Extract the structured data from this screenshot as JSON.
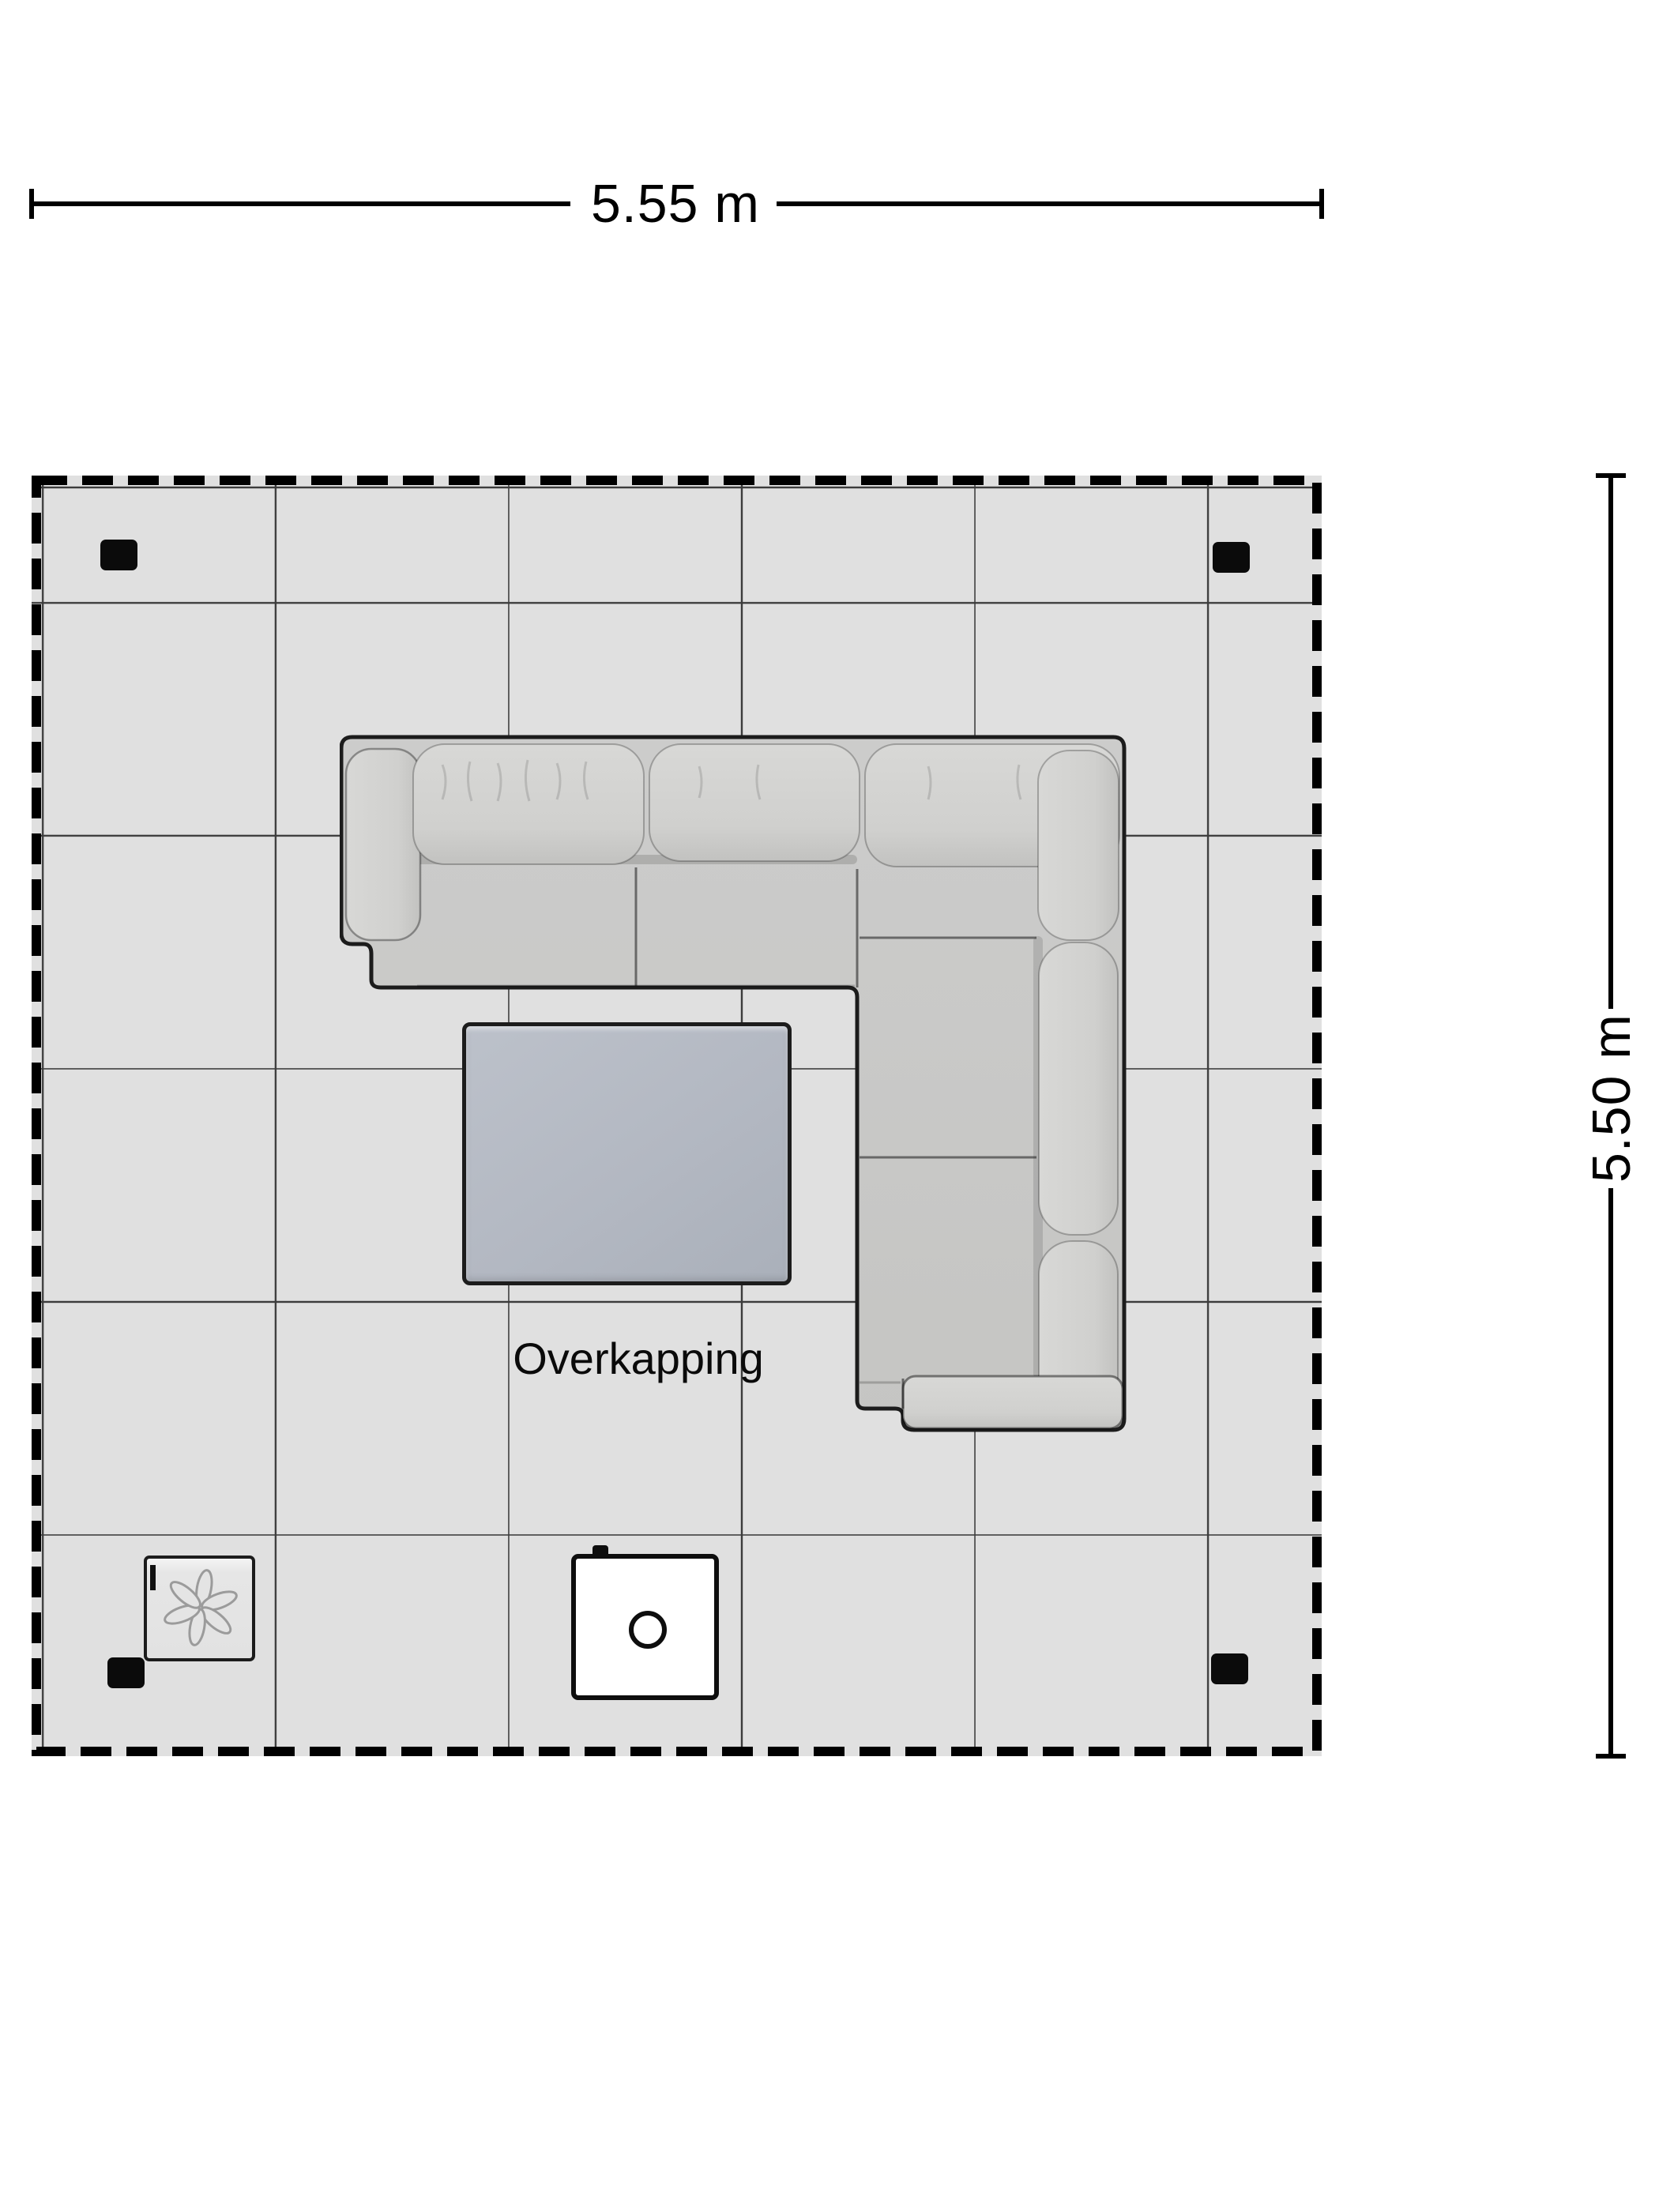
{
  "dimension_top": {
    "label": "5.55 m"
  },
  "dimension_right": {
    "label": "5.50 m"
  },
  "floor_area": {
    "label": "Overkapping"
  },
  "colors": {
    "background": "#ffffff",
    "floor_fill": "#e0e0e0",
    "grid_line": "#3c3c3c",
    "dashed_border": "#000000",
    "post": "#0b0b0b",
    "sofa_fabric": "#c9c9c7",
    "sofa_cushion": "#d3d3d1",
    "sofa_outline": "#1c1c1c",
    "table_fill": "#b6bbc4",
    "fire_table_fill": "#ffffff"
  },
  "icons": {
    "heater": "fan-icon",
    "fire_table": "burner-circle-icon"
  }
}
